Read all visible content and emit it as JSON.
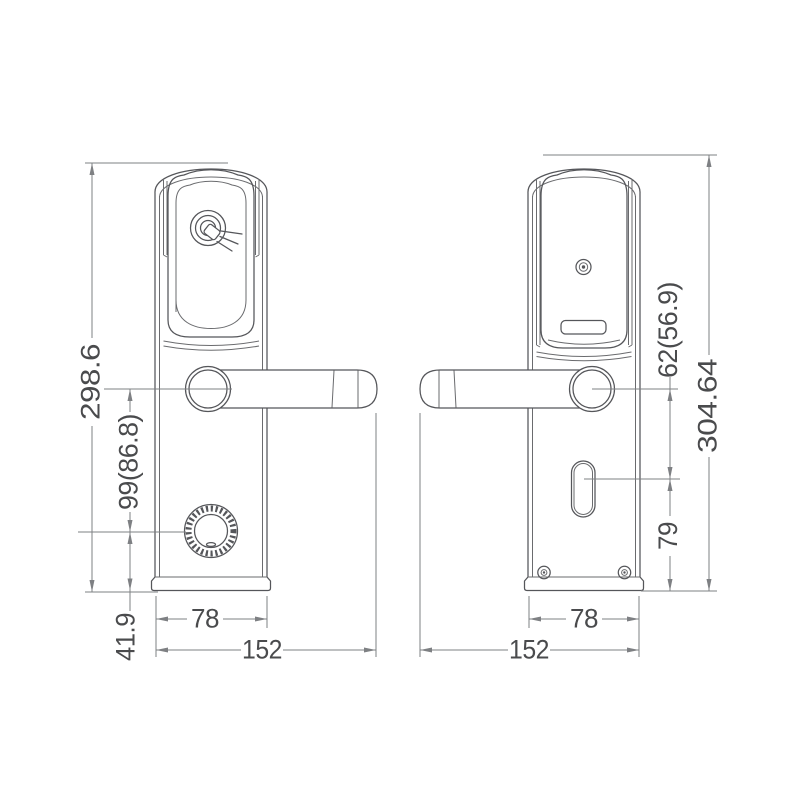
{
  "drawing": {
    "type": "technical-dimension-drawing",
    "subject": "electronic-door-lock-front-and-back-views",
    "colors": {
      "background": "#ffffff",
      "body_line": "#55565a",
      "dimension_line": "#7e8083",
      "text": "#4a4b4d"
    },
    "icons": {
      "front": [
        "rfid-card-reader-icon",
        "lever-handle",
        "privacy-knob"
      ],
      "back": [
        "screw-hole-icon",
        "battery-slot",
        "lever-handle",
        "keyhole",
        "fixing-screws"
      ]
    }
  },
  "views": {
    "front": {
      "dimensions": {
        "overall_height": "298.6",
        "handle_to_knob": "99(86.8)",
        "knob_to_bottom": "41.9",
        "plate_width": "78",
        "overall_width": "152"
      }
    },
    "back": {
      "dimensions": {
        "handle_to_keyhole": "62(56.9)",
        "overall_height": "304.64",
        "keyhole_to_bottom": "79",
        "plate_width": "78",
        "overall_width": "152"
      }
    }
  }
}
